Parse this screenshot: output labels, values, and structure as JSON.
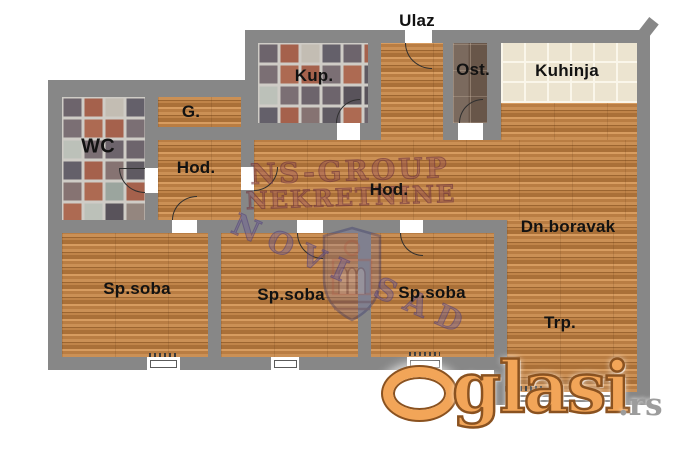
{
  "plan": {
    "rooms": [
      {
        "id": "ulaz",
        "label": "Ulaz"
      },
      {
        "id": "kupatilo",
        "label": "Kup."
      },
      {
        "id": "ostava",
        "label": "Ost."
      },
      {
        "id": "kuhinja",
        "label": "Kuhinja"
      },
      {
        "id": "wc",
        "label": "WC"
      },
      {
        "id": "garderoba",
        "label": "G."
      },
      {
        "id": "hodnik-levi",
        "label": "Hod."
      },
      {
        "id": "hodnik-glavni",
        "label": "Hod."
      },
      {
        "id": "dnevni-boravak",
        "label": "Dn.boravak"
      },
      {
        "id": "trpezarija",
        "label": "Trp."
      },
      {
        "id": "spavaca-soba-1",
        "label": "Sp.soba"
      },
      {
        "id": "spavaca-soba-2",
        "label": "Sp.soba"
      },
      {
        "id": "spavaca-soba-3",
        "label": "Sp.soba"
      }
    ],
    "watermark": {
      "agency_line1": "NS-GROUP",
      "agency_line2": "NEKRETNINE",
      "city": "NOVI SAD"
    },
    "logo": {
      "brand": "Oglasi.rs",
      "name_rest": "glasi",
      "tld": ".rs"
    },
    "colors": {
      "wall": "#878787",
      "wood": "#c4854c",
      "kitchen_tile": "#ece4d0",
      "logo_orange": "#f2a558",
      "watermark_red": "#974f56",
      "watermark_purple": "#6c5c96"
    }
  }
}
